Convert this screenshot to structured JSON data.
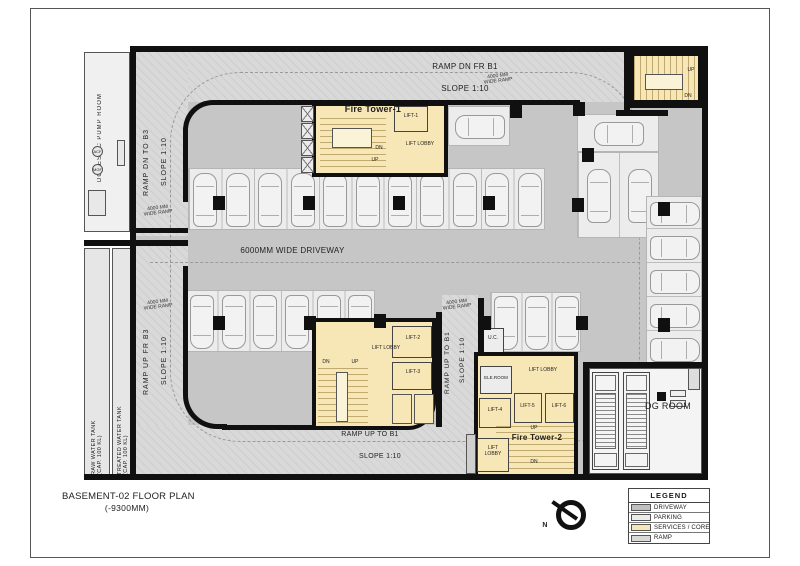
{
  "title": {
    "line1": "BASEMENT-02 FLOOR PLAN",
    "line2": "(-9300MM)"
  },
  "labels": {
    "ramp_dn_fr_b1": "RAMP DN FR B1",
    "ramp_dn_to_b3": "RAMP DN TO B3",
    "ramp_up_fr_b3": "RAMP UP FR B3",
    "ramp_up_to_b1": "RAMP UP TO B1",
    "slope": "SLOPE 1:10",
    "wide_ramp_l1": "4000 MM",
    "wide_ramp_l2": "WIDE RAMP",
    "driveway": "6000MM WIDE DRIVEWAY",
    "domestic_pump_room": "DOMESTIC PUMP ROOM",
    "raw_water_tank": "RAW WATER TANK",
    "treated_water_tank": "TREATED WATER TANK",
    "cap": "(CAP. 100 KL)",
    "fire_tower_1": "Fire Tower-1",
    "fire_tower_2": "Fire Tower-2",
    "lift_lobby": "LIFT LOBBY",
    "lift_1": "LIFT-1",
    "lift_2": "LIFT-2",
    "lift_3": "LIFT-3",
    "lift_4": "LIFT-4",
    "lift_5": "LIFT-5",
    "lift_6": "LIFT-6",
    "ele_room": "ELE.ROOM",
    "uc": "U.C.",
    "dg_room": "DG ROOM",
    "up": "UP",
    "dn": "DN",
    "north": "N",
    "acf": "ACF",
    "mgf": "MGF"
  },
  "colors": {
    "driveway": "#c6c6c6",
    "parking": "#ececec",
    "services": "#f7e7b6",
    "ramp": "#d9d9d9",
    "wall": "#101010"
  },
  "legend": {
    "title": "LEGEND",
    "items": [
      {
        "label": "DRIVEWAY",
        "color": "#c0c0c0"
      },
      {
        "label": "PARKING",
        "color": "#ececec"
      },
      {
        "label": "SERVICES / CORE",
        "color": "#f7e7b6"
      },
      {
        "label": "RAMP",
        "color": "#d9d9d9"
      }
    ]
  },
  "parking": {
    "groups": [
      {
        "name": "top-row",
        "x": 188,
        "y": 168,
        "w": 357,
        "h": 62,
        "count": 11,
        "dir": "up"
      },
      {
        "name": "mid-row",
        "x": 185,
        "y": 290,
        "w": 190,
        "h": 62,
        "count": 6,
        "dir": "down"
      },
      {
        "name": "right-mid",
        "x": 490,
        "y": 292,
        "w": 91,
        "h": 60,
        "count": 3,
        "dir": "down"
      },
      {
        "name": "island-horiz",
        "x": 577,
        "y": 114,
        "w": 82,
        "h": 38,
        "count": 1,
        "dir": "left"
      },
      {
        "name": "island-vert",
        "x": 577,
        "y": 152,
        "w": 82,
        "h": 86,
        "count": 2,
        "dir": "up"
      },
      {
        "name": "right-edge",
        "x": 646,
        "y": 196,
        "w": 56,
        "h": 170,
        "count": 5,
        "dir": "right"
      },
      {
        "name": "single-stall",
        "x": 448,
        "y": 106,
        "w": 62,
        "h": 40,
        "count": 1,
        "dir": "left"
      }
    ]
  },
  "structure": {
    "columns": [
      [
        213,
        196
      ],
      [
        303,
        196
      ],
      [
        393,
        196
      ],
      [
        483,
        196
      ],
      [
        510,
        104
      ],
      [
        573,
        102
      ],
      [
        213,
        316
      ],
      [
        304,
        316
      ],
      [
        374,
        314
      ],
      [
        479,
        316
      ],
      [
        576,
        316
      ],
      [
        582,
        148
      ],
      [
        572,
        198
      ],
      [
        658,
        202
      ],
      [
        658,
        318
      ]
    ]
  }
}
